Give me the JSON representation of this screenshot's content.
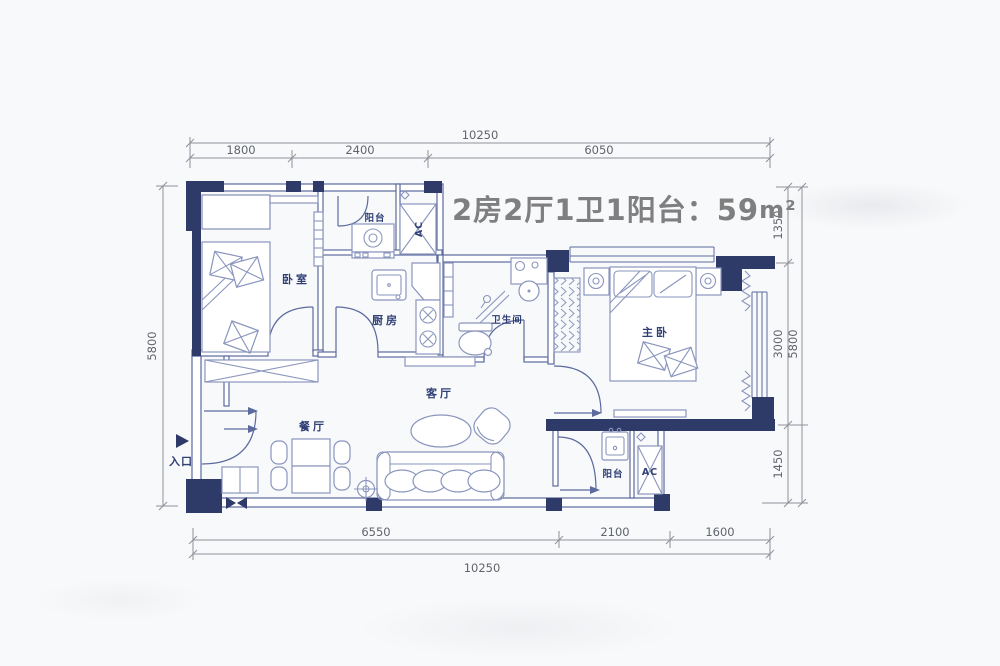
{
  "title": {
    "main": "2房2厅1卫1阳台：59",
    "unit": "m²"
  },
  "rooms": {
    "bedroom": "卧室",
    "balcony_top": "阳台",
    "ac_top": "AC",
    "kitchen": "厨房",
    "bathroom": "卫生间",
    "master_bedroom": "主卧",
    "living_room": "客厅",
    "dining_room": "餐厅",
    "entrance": "入口",
    "balcony_bottom": "阳台",
    "ac_bottom": "AC"
  },
  "dimensions": {
    "top": {
      "total": "10250",
      "segments": [
        "1800",
        "2400",
        "6050"
      ]
    },
    "bottom": {
      "total": "10250",
      "segments": [
        "6550",
        "2100",
        "1600"
      ]
    },
    "left": {
      "total": "5800"
    },
    "right": {
      "total": "5800",
      "segments": [
        "1350",
        "3000",
        "1450"
      ]
    }
  },
  "colors": {
    "wall": "#2e3a68",
    "line": "#5c6a9e",
    "furn": "#8a95bd",
    "dim": "#8e9199",
    "dimtext": "#60646b",
    "label": "#2f3f76",
    "title": "#7f7f80",
    "bg": "#f8f9fb"
  }
}
